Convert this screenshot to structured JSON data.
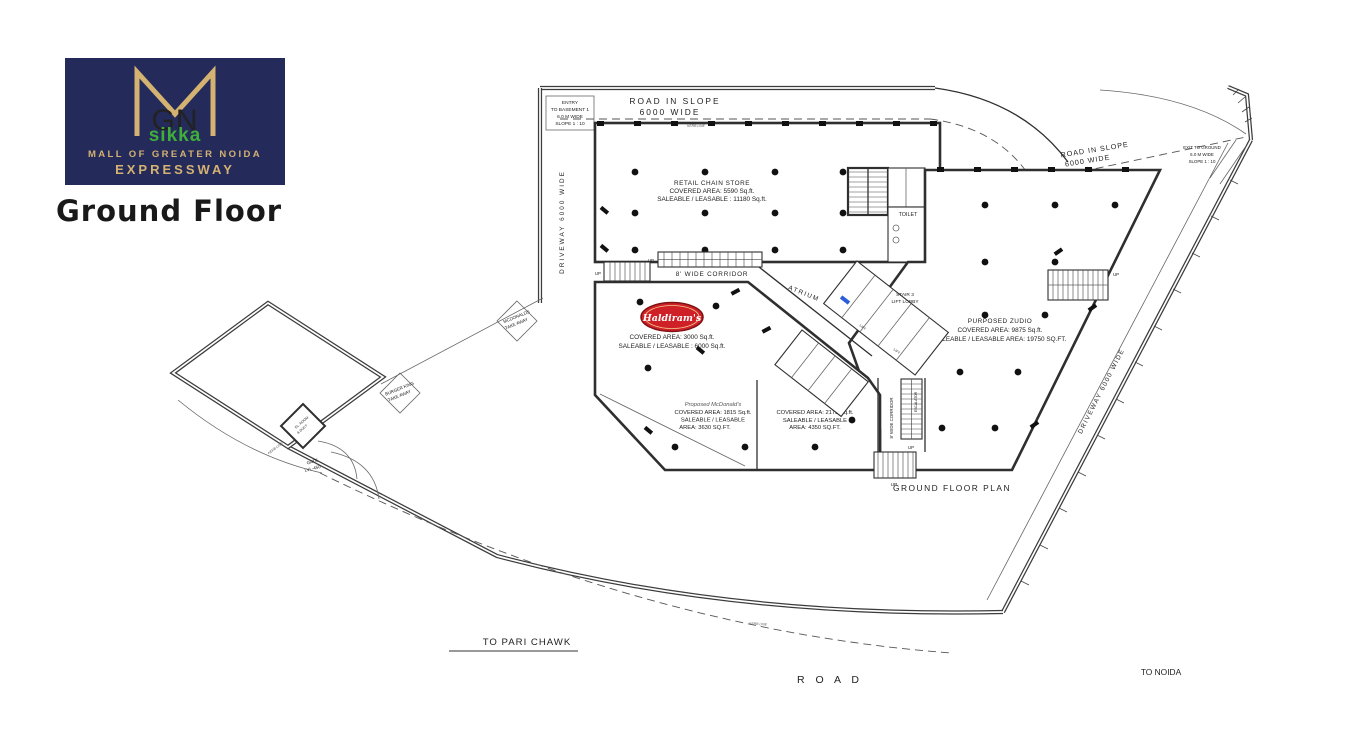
{
  "branding": {
    "monogram": "GN",
    "brand": "sikka",
    "mall_line": "MALL OF GREATER NOIDA",
    "expressway_line": "EXPRESSWAY",
    "page_title": "Ground Floor",
    "colors": {
      "navy": "#242a5a",
      "gold": "#d3b272",
      "green": "#3fae3b",
      "haldiram_red": "#cf2027",
      "marker_blue": "#2b5fd9"
    }
  },
  "plan": {
    "caption": "GROUND FLOOR PLAN",
    "road_top": {
      "l1": "ROAD IN SLOPE",
      "l2": "6000 WIDE"
    },
    "road_right": {
      "l1": "ROAD IN SLOPE",
      "l2": "6000 WIDE"
    },
    "entry_basement": {
      "l1": "ENTRY",
      "l2": "TO BASEMENT 1",
      "l3": "6.0 M WIDE",
      "l4": "SLOPE 1 : 10"
    },
    "exit_ground": {
      "l1": "EXIT TO GROUND",
      "l2": "6.0 M WIDE",
      "l3": "SLOPE 1 : 10"
    },
    "driveway_left": "DRIVEWAY 6000 WIDE",
    "driveway_right": "DRIVEWAY 6000 WIDE",
    "kerb_line": "KERB LINE",
    "retail": {
      "name": "RETAIL CHAIN STORE",
      "covered": "COVERED AREA: 5590 Sq.ft.",
      "saleable": "SALEABLE / LEASABLE : 11180 Sq.ft."
    },
    "haldirams": {
      "logo_text": "Haldiram's",
      "covered": "COVERED AREA: 3000 Sq.ft.",
      "saleable": "SALEABLE / LEASABLE : 6000 Sq.ft."
    },
    "zudio": {
      "name": "PURPOSED ZUDIO",
      "covered": "COVERED AREA: 9875 Sq.ft.",
      "saleable": "SALEABLE / LEASABLE AREA: 19750 SQ.FT."
    },
    "mcdonalds": {
      "name": "Proposed McDonald's",
      "covered": "COVERED AREA: 1815 Sq.ft.",
      "l3": "SALEABLE / LEASABLE",
      "l4": "AREA: 3630 SQ.FT."
    },
    "shop2": {
      "covered": "COVERED AREA: 2175 Sq.ft.",
      "l2": "SALEABLE / LEASABLE",
      "l3": "AREA: 4350 SQ.FT."
    },
    "mcd_takeaway": {
      "l1": "MCDONALDS",
      "l2": "TAKE AWAY"
    },
    "bk_takeaway": {
      "l1": "BURGER KING",
      "l2": "TAKE AWAY"
    },
    "el_room": {
      "l1": "EL. ROOM",
      "l2": "& DUCT"
    },
    "gate": {
      "l1": "GATE",
      "l2": "LVL-450"
    },
    "toilet": "TOILET",
    "atrium": "ATRIUM",
    "corridor": "8' WIDE CORRIDOR",
    "stair_lobby": {
      "l1": "STAIR 3",
      "l2": "LIFT LOBBY"
    },
    "lift": "LIFT",
    "escalator": "ESCALATOR",
    "up": "UP",
    "to_pari_chawk": "TO PARI CHAWK",
    "road_label": "R O A D",
    "to_noida": "TO NOIDA"
  }
}
